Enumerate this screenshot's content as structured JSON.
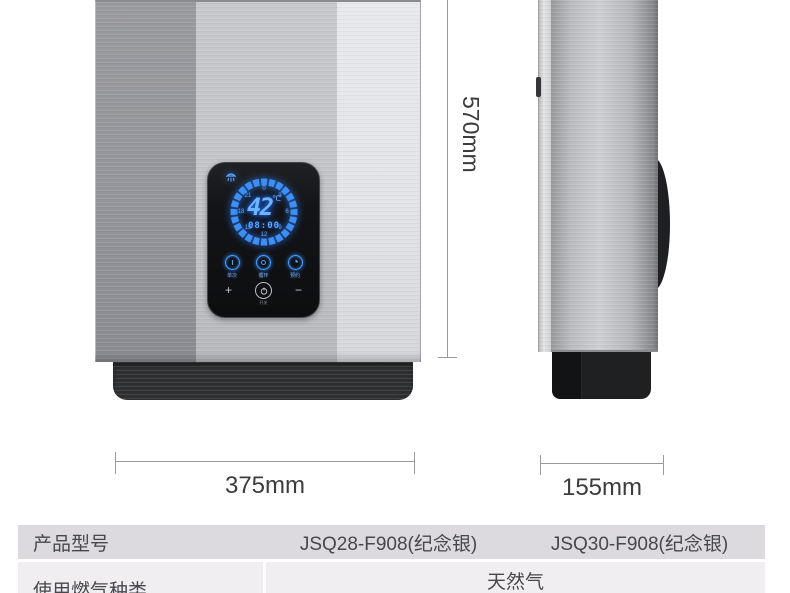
{
  "control_panel": {
    "temperature_value": "42",
    "temperature_unit": "℃",
    "time_display": "08:00",
    "dial_numbers": [
      "0",
      "3",
      "6",
      "9",
      "12",
      "15",
      "18",
      "21"
    ],
    "function_buttons": [
      {
        "label": "单次"
      },
      {
        "label": "循环"
      },
      {
        "label": "预约"
      }
    ],
    "plus_label": "+",
    "minus_label": "−",
    "power_label": "开关",
    "display_glow_color": "#3d9bff"
  },
  "dimension_annotations": {
    "height": "570mm",
    "width": "375mm",
    "depth": "155mm"
  },
  "spec_table": {
    "rows": [
      {
        "label": "产品型号",
        "values": [
          "JSQ28-F908(纪念银)",
          "JSQ30-F908(纪念银)"
        ]
      },
      {
        "label": "使用燃气种类",
        "values": [
          "天然气"
        ]
      }
    ]
  },
  "colors": {
    "table_header_bg": "#dcdade",
    "table_row_bg": "#f0eef1",
    "base_black": "#2e2f31",
    "dimension_text": "#3c3c3c"
  }
}
